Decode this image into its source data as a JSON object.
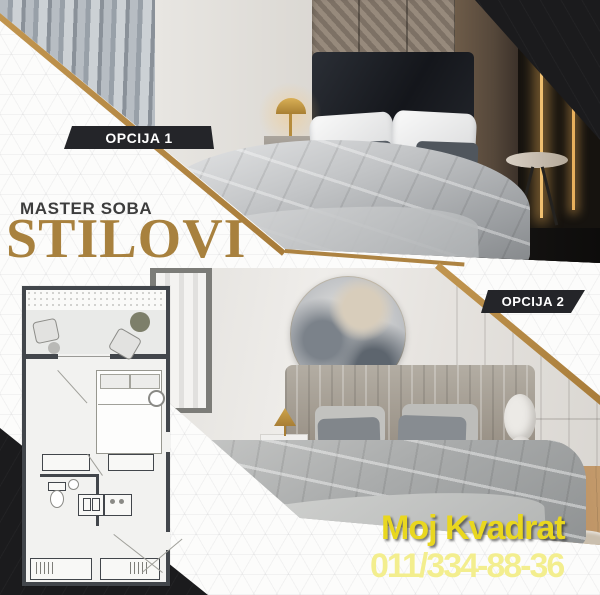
{
  "badges": {
    "option1": "OPCIJA 1",
    "option2": "OPCIJA 2"
  },
  "title": {
    "kicker": "MASTER SOBA",
    "main": "STILOVI"
  },
  "footer": {
    "company": "Moj Kvadrat",
    "phone": "011/334-88-36"
  },
  "colors": {
    "gold": "#b08544",
    "title_gold": "#a8813e",
    "badge_bg": "#242529",
    "badge_text": "#ffffff",
    "company_yellow": "#e9d71f",
    "phone_yellow": "#f3ee8e",
    "corner_black": "#1b1b1d",
    "background": "#fcfcfb"
  }
}
